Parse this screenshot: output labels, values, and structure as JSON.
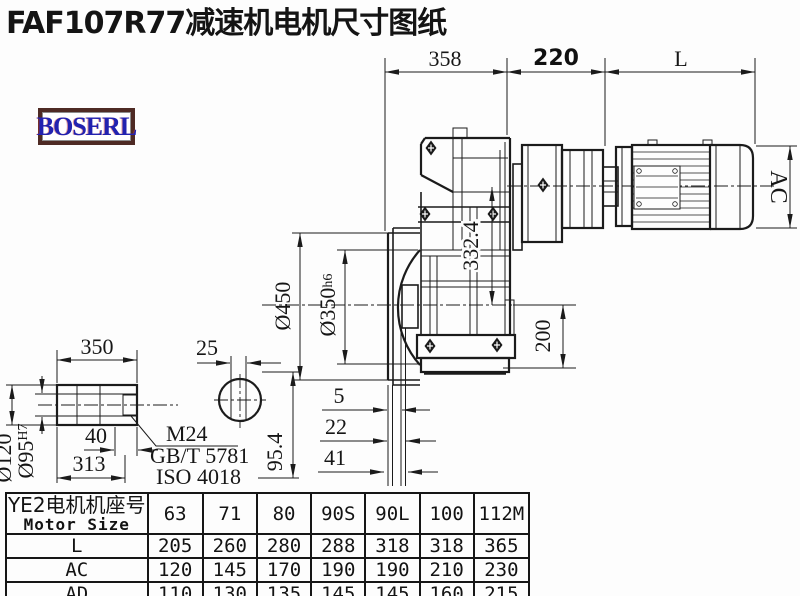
{
  "title": "FAF107R77减速机电机尺寸图纸",
  "logo": "BOSERL",
  "dims": {
    "width_358": "358",
    "width_220": "220",
    "width_L": "L",
    "ac": "AC",
    "flange_od": "Ø450",
    "spigot_d": "Ø350",
    "spigot_tol": "h6",
    "center_332": "332.4",
    "height_200": "200",
    "shaft_len_350": "350",
    "key_25": "25",
    "shaft_od_120": "Ø120",
    "bore_95": "Ø95",
    "bore_tol": "H7",
    "depth_40": "40",
    "len_313": "313",
    "thread": "M24",
    "std_gb": "GB/T 5781",
    "std_iso": "ISO 4018",
    "height_954": "95.4",
    "gap_5": "5",
    "gap_22": "22",
    "gap_41": "41"
  },
  "table": {
    "header_cn": "YE2电机机座号",
    "header_en": "Motor Size",
    "columns": [
      "63",
      "71",
      "80",
      "90S",
      "90L",
      "100",
      "112M"
    ],
    "rows": [
      {
        "label": "L",
        "values": [
          "205",
          "260",
          "280",
          "288",
          "318",
          "318",
          "365"
        ]
      },
      {
        "label": "AC",
        "values": [
          "120",
          "145",
          "170",
          "190",
          "190",
          "210",
          "230"
        ]
      },
      {
        "label": "AD",
        "values": [
          "110",
          "130",
          "135",
          "145",
          "145",
          "160",
          "215"
        ]
      }
    ]
  },
  "colors": {
    "line": "#1b1b1b",
    "logo_text": "#2222b0",
    "logo_border": "#4e2a24"
  }
}
